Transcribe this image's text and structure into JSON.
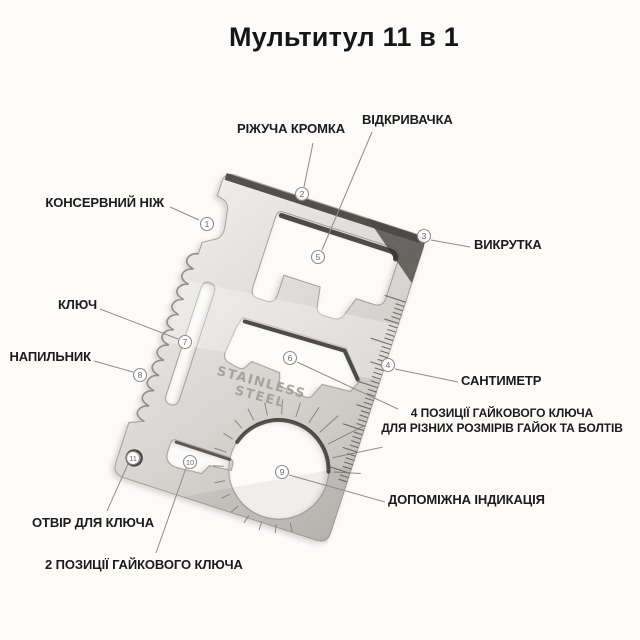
{
  "title": "Мультитул 11 в 1",
  "tool": {
    "engraving_line1": "STAINLESS",
    "engraving_line2": "STEEL"
  },
  "parts": [
    {
      "num": "1",
      "label": "КОНСЕРВНИЙ НІЖ"
    },
    {
      "num": "2",
      "label": "РІЖУЧА КРОМКА"
    },
    {
      "num": "3",
      "label": "ВИКРУТКА"
    },
    {
      "num": "4",
      "label": "САНТИМЕТР"
    },
    {
      "num": "5",
      "label": "ВІДКРИВАЧКА"
    },
    {
      "num": "6",
      "label": "4 ПОЗИЦІЇ ГАЙКОВОГО КЛЮЧА\nДЛЯ РІЗНИХ РОЗМІРІВ ГАЙОК ТА БОЛТІВ"
    },
    {
      "num": "7",
      "label": "КЛЮЧ"
    },
    {
      "num": "8",
      "label": "НАПИЛЬНИК"
    },
    {
      "num": "9",
      "label": "ДОПОМІЖНА ІНДИКАЦІЯ"
    },
    {
      "num": "10",
      "label": "2 ПОЗИЦІЇ ГАЙКОВОГО КЛЮЧА"
    },
    {
      "num": "11",
      "label": "ОТВІР ДЛЯ КЛЮЧА"
    }
  ],
  "colors": {
    "background": "#fcfbfa",
    "label_text": "#1b1b1b",
    "leader_line": "#8f8d8a",
    "callout_fill": "#ffffff",
    "callout_number": "#6a6a6a",
    "metal_light": "#f0eeec",
    "metal_dark": "#bfbcb8",
    "edge_dark": "#45423f",
    "engraving": "#a19c96",
    "tick": "#55514d"
  }
}
